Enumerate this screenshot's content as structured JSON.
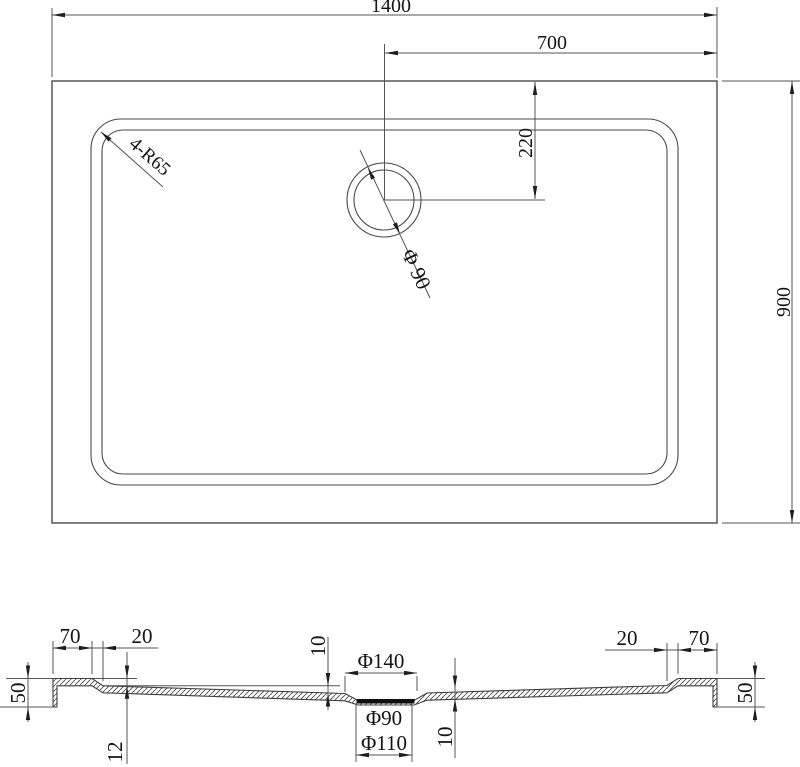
{
  "drawing": {
    "top_view": {
      "overall_width": "1400",
      "drain_offset_from_right": "700",
      "drain_offset_from_top": "220",
      "overall_depth": "900",
      "corner_radius": "4-R65",
      "drain_diameter": "Φ 90"
    },
    "section_view": {
      "left_rim_width": "70",
      "left_step_width": "20",
      "left_edge_height": "50",
      "rim_step_depth": "12",
      "floor_thickness_left": "10",
      "drain_recess_diameter": "Φ140",
      "waste_hole_diameter": "Φ90",
      "drain_flange_diameter": "Φ110",
      "floor_thickness_right": "10",
      "right_step_width": "20",
      "right_rim_width": "70",
      "right_edge_height": "50"
    },
    "colors": {
      "line": "#3f3f3f",
      "dimension_line": "#545454",
      "text": "#141414",
      "background": "#ffffff"
    }
  }
}
